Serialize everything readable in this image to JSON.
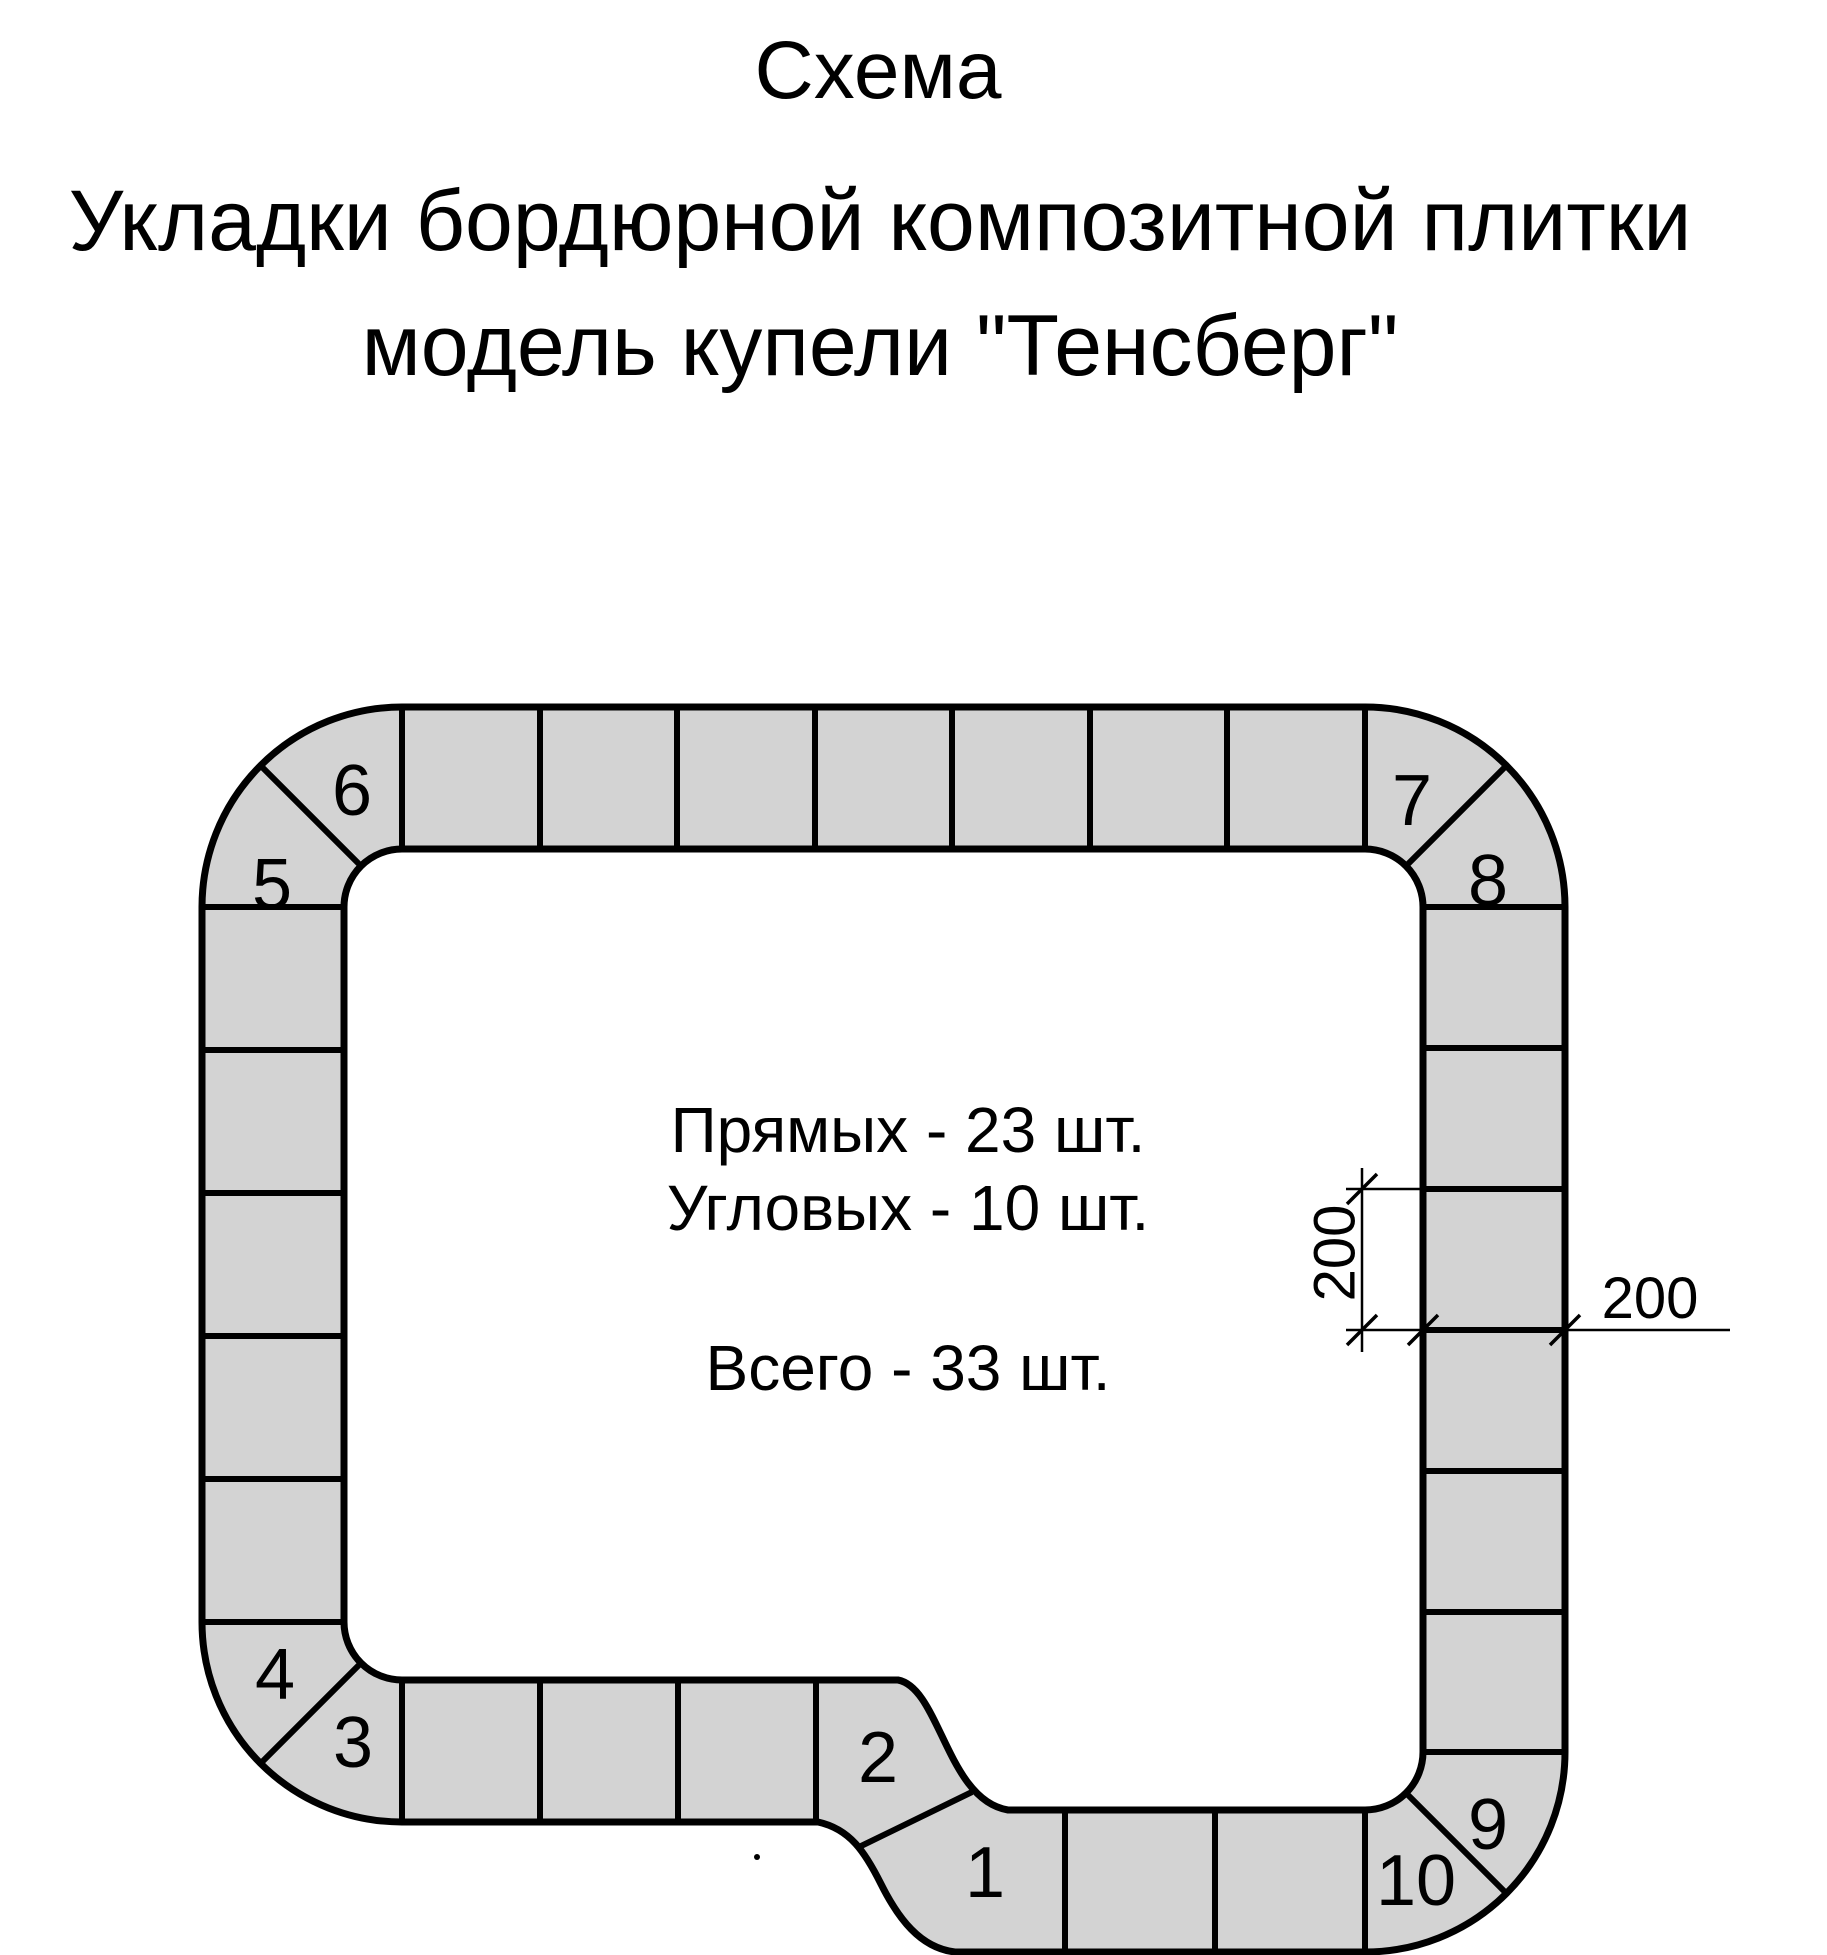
{
  "title": {
    "line1": "Схема",
    "line2": "Укладки бордюрной композитной плитки",
    "line3": "модель купели \"Тенсберг\""
  },
  "summary": {
    "straight_line": "Прямых - 23 шт.",
    "corner_line": "Угловых - 10 шт.",
    "total_line": "Всего - 33 шт."
  },
  "counts": {
    "straight_tiles": 23,
    "corner_tiles": 10,
    "total_tiles": 33
  },
  "dimensions": {
    "tile_height_label": "200",
    "tile_width_label": "200"
  },
  "corner_tiles": [
    {
      "label": "1"
    },
    {
      "label": "2"
    },
    {
      "label": "3"
    },
    {
      "label": "4"
    },
    {
      "label": "5"
    },
    {
      "label": "6"
    },
    {
      "label": "7"
    },
    {
      "label": "8"
    },
    {
      "label": "9"
    },
    {
      "label": "10"
    }
  ],
  "colors": {
    "tile_fill": "#d3d3d3",
    "line": "#000000",
    "background": "#ffffff"
  }
}
